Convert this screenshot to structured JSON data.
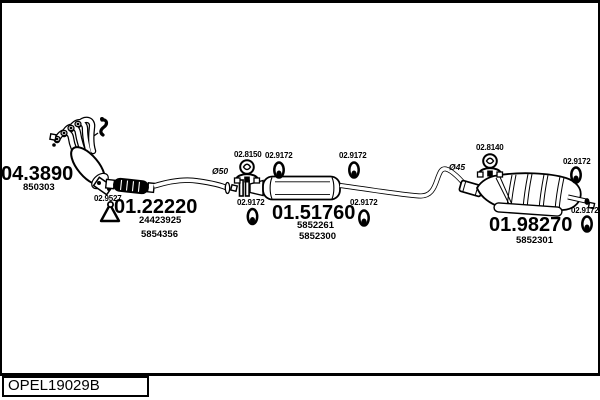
{
  "colors": {
    "line": "#000000",
    "background": "#ffffff"
  },
  "title_block": {
    "drawing_code": "OPEL19029B"
  },
  "parts": {
    "manifold": {
      "code": "04.3890",
      "oe_numbers": [
        "850303"
      ]
    },
    "front_pipe": {
      "code": "01.22220",
      "oe_numbers": [
        "24423925",
        "5854356"
      ]
    },
    "center_muffler": {
      "code": "01.51760",
      "oe_numbers": [
        "5852261",
        "5852300"
      ]
    },
    "rear_muffler": {
      "code": "01.98270",
      "oe_numbers": [
        "5852301"
      ]
    }
  },
  "hardware": {
    "rubber_mount": {
      "code": "02.9527"
    },
    "front_clamp": {
      "code": "02.8150"
    },
    "rear_clamp": {
      "code": "02.8140"
    },
    "hanger_ring": {
      "code": "02.9172"
    }
  },
  "annotations": {
    "front_pipe_diameter": "Ø50",
    "rear_pipe_diameter": "Ø45"
  }
}
